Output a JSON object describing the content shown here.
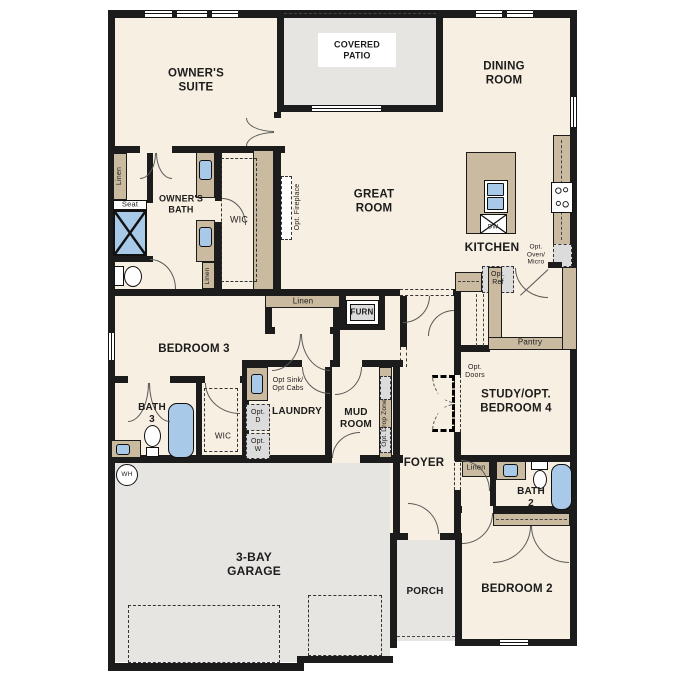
{
  "colors": {
    "wall": "#1c1c1c",
    "floor": "#f7efe1",
    "concrete": "#e6e5e2",
    "cabinet": "#c9baa0",
    "fixture": "#a9c9e9",
    "optional_fill": "#dcdcdc",
    "label": "#1c1c1c"
  },
  "labels": {
    "owners_suite": "OWNER'S\nSUITE",
    "covered_patio": "COVERED\nPATIO",
    "dining_room": "DINING\nROOM",
    "great_room": "GREAT\nROOM",
    "kitchen": "KITCHEN",
    "opt_oven_micro": "Opt.\nOven/\nMicro",
    "opt_ref": "Opt.\nRef",
    "pantry": "Pantry",
    "owners_bath": "OWNER'S\nBATH",
    "wic_owners": "WIC",
    "linen_owners_upper": "Linen",
    "linen_owners_lower": "Linen",
    "seat": "Seat",
    "opt_fireplace": "Opt. Fireplace",
    "linen_hall": "Linen",
    "furn": "FURN",
    "bedroom3": "BEDROOM 3",
    "bath3": "BATH\n3",
    "wic_bed3": "WIC",
    "opt_sink_cabs": "Opt Sink/\nOpt Cabs",
    "laundry": "LAUNDRY",
    "opt_d": "Opt.\nD",
    "opt_w": "Opt.\nW",
    "mud_room": "MUD\nROOM",
    "opt_drop_zone": "Opt. Drop Zone",
    "foyer": "FOYER",
    "opt_doors": "Opt.\nDoors",
    "study": "STUDY/OPT.\nBEDROOM 4",
    "linen_bath2": "Linen",
    "bath2": "BATH\n2",
    "bedroom2": "BEDROOM 2",
    "porch": "PORCH",
    "garage": "3-BAY\nGARAGE",
    "wh": "WH",
    "dw": "DW"
  }
}
